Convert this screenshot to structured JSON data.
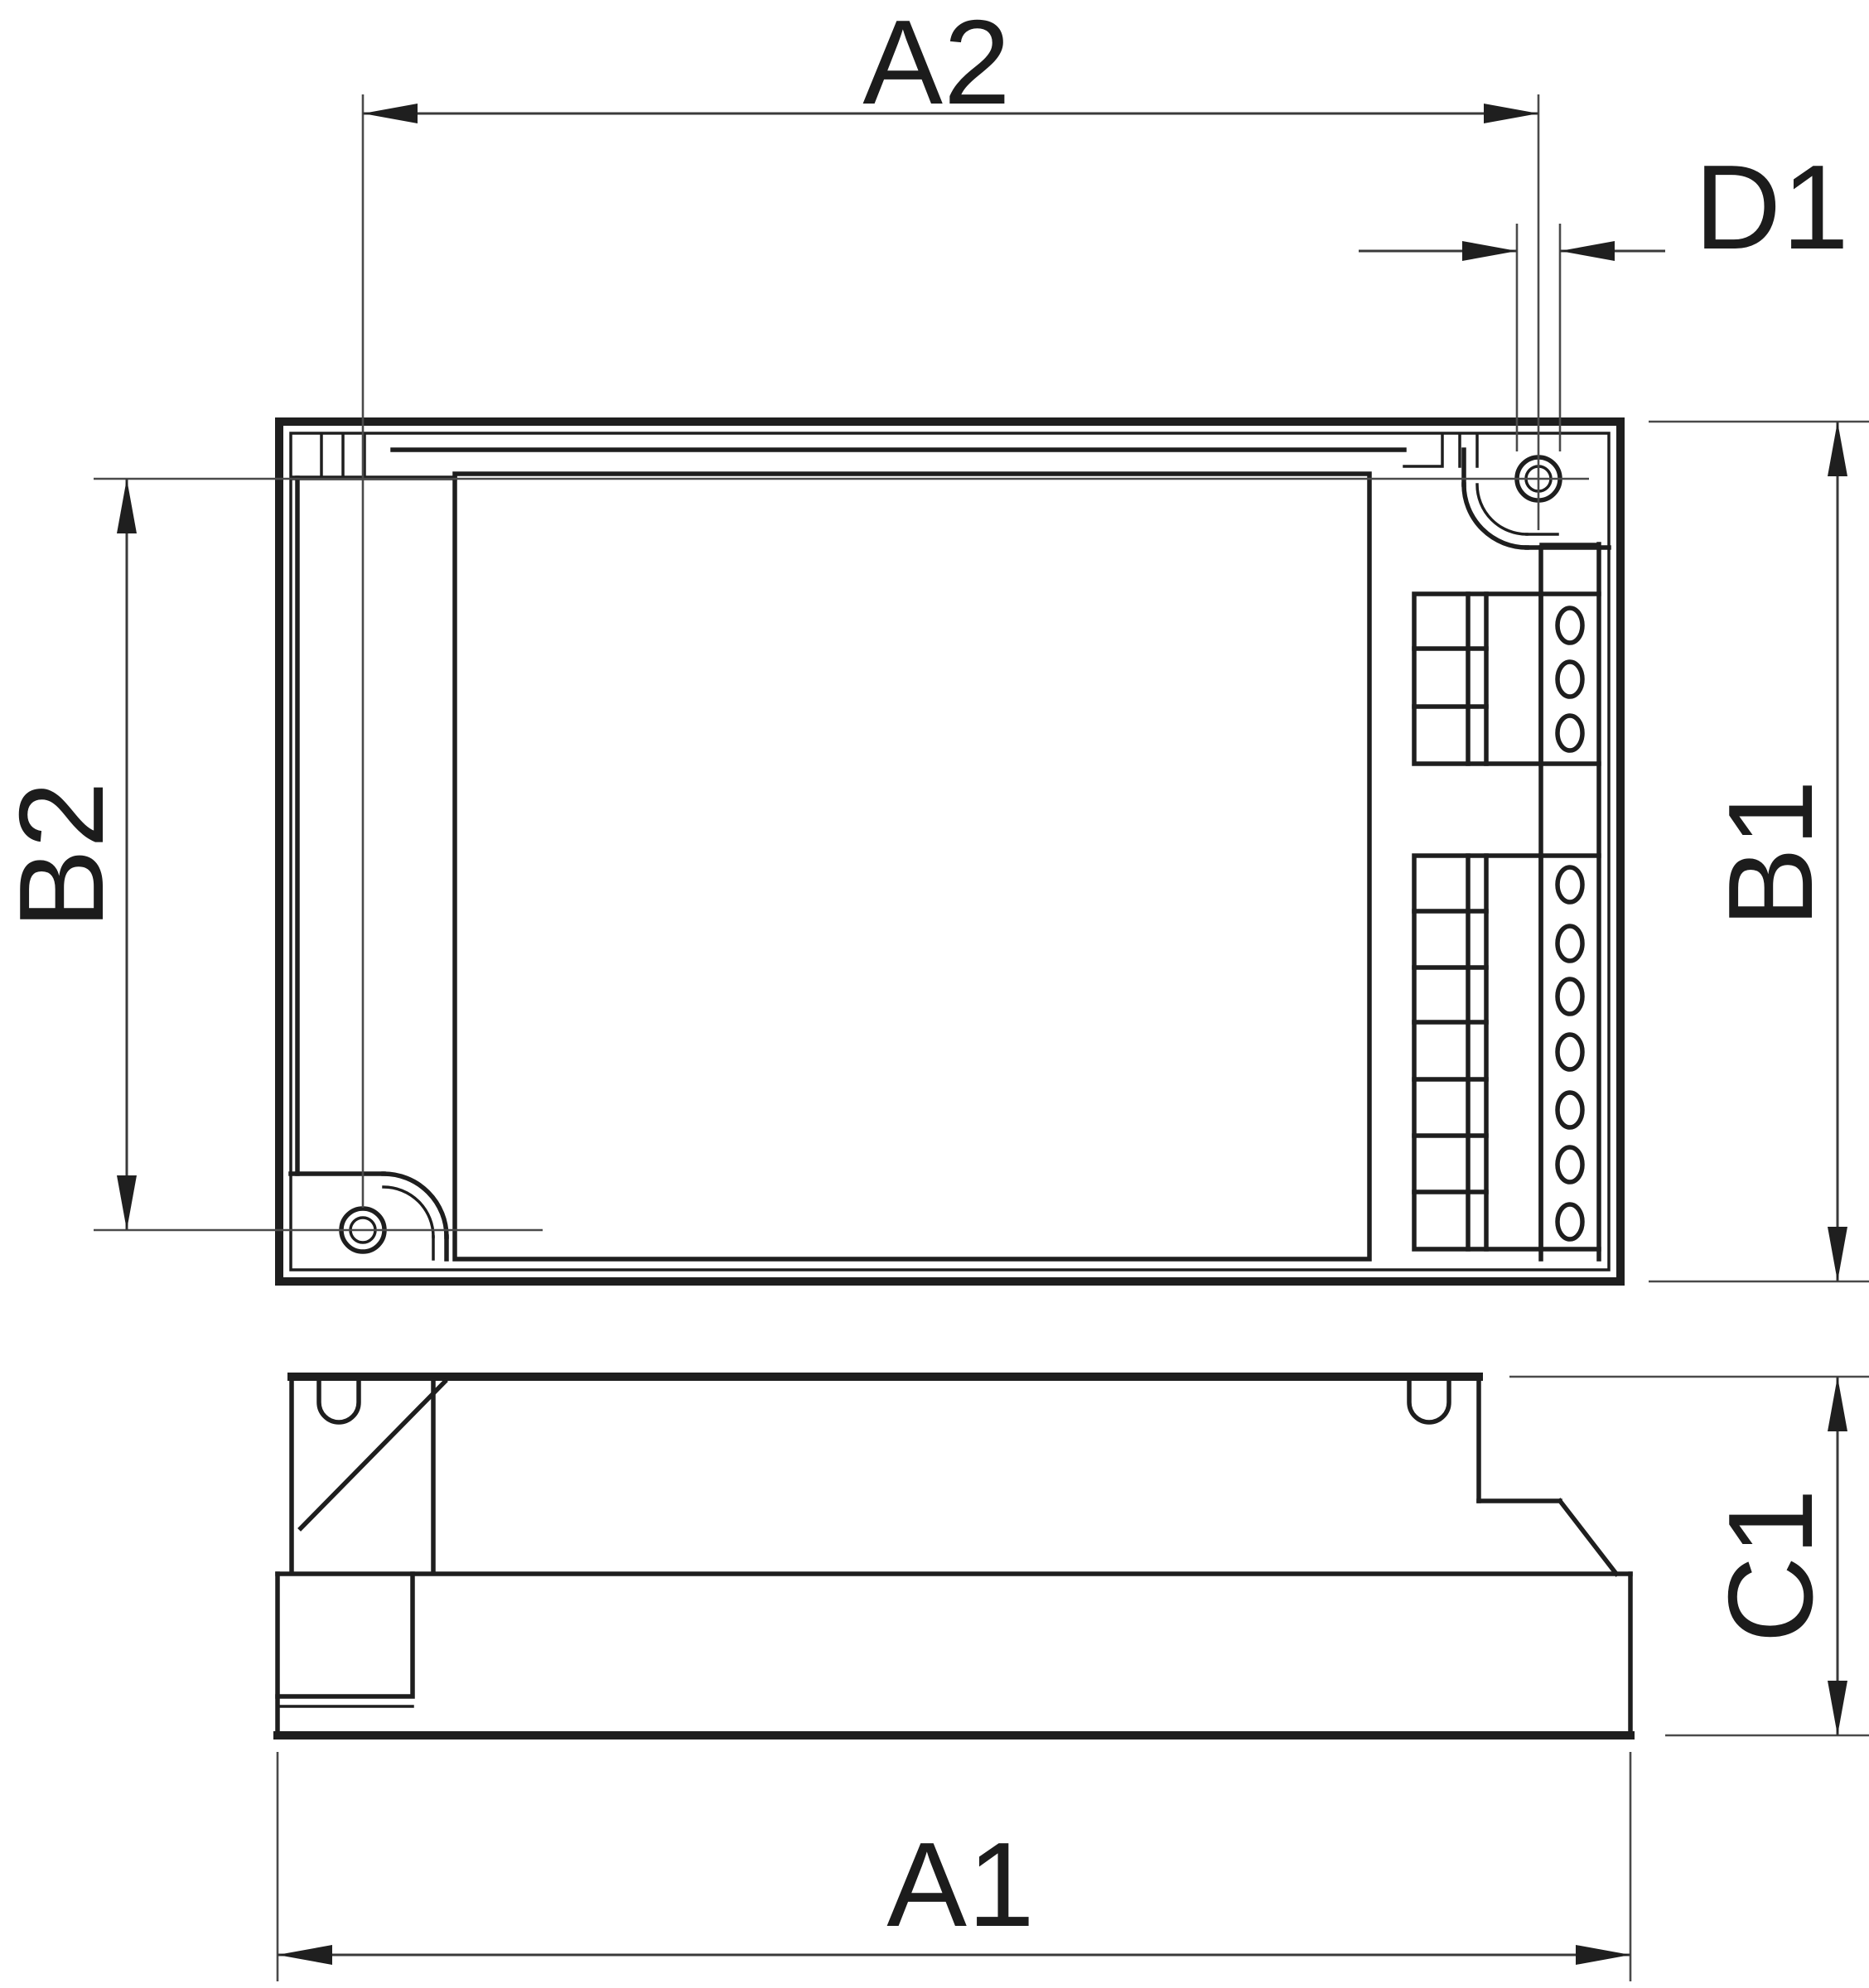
{
  "drawing": {
    "type": "technical-dimension-drawing",
    "colors": {
      "background": "#ffffff",
      "outline": "#1e1e1e",
      "dimension_lines": "#3a3a3a",
      "text": "#1c1c1c"
    },
    "labels": {
      "a2": "A2",
      "d1": "D1",
      "b2": "B2",
      "b1": "B1",
      "c1": "C1",
      "a1": "A1"
    },
    "top_view": {
      "mounting_holes": 2,
      "terminal_block_upper_ovals": 3,
      "terminal_block_lower_ovals": 7
    },
    "side_view": {
      "snap_notches": 2
    }
  }
}
